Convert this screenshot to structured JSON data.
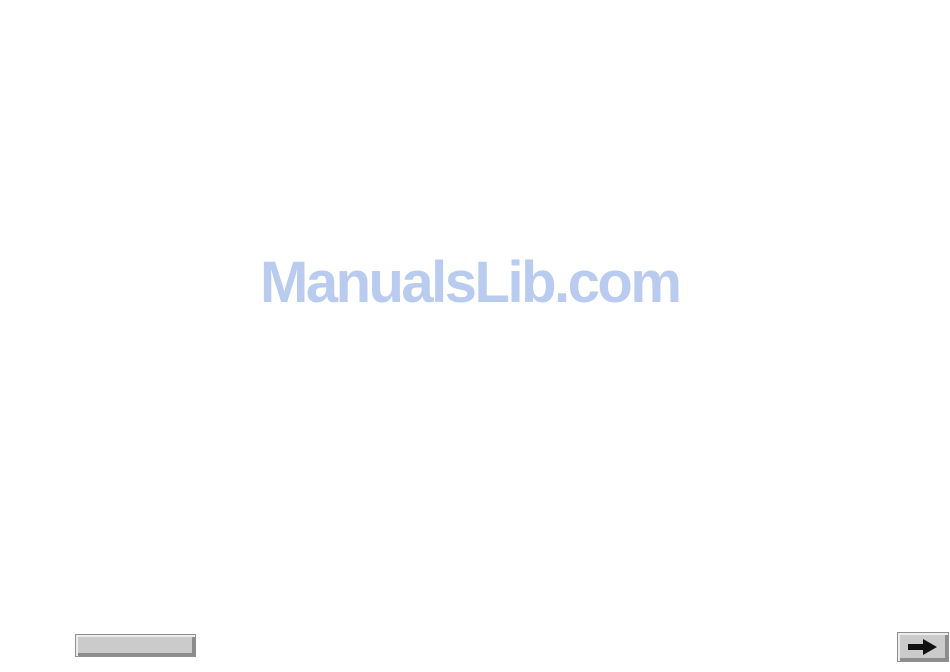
{
  "watermark": {
    "text": "ManualsLib.com",
    "color": "#b9cbee"
  },
  "schematic": {
    "kind": "circuit-schematic-scan",
    "ink_color": "#1c1c1c",
    "annotation_color": "#cf8f8f",
    "label_color": "#a8a8b0"
  },
  "nav": {
    "prev_button_label": "",
    "next_button_icon": "arrow-right"
  },
  "marks": {
    "crop_mark_count": 4
  }
}
